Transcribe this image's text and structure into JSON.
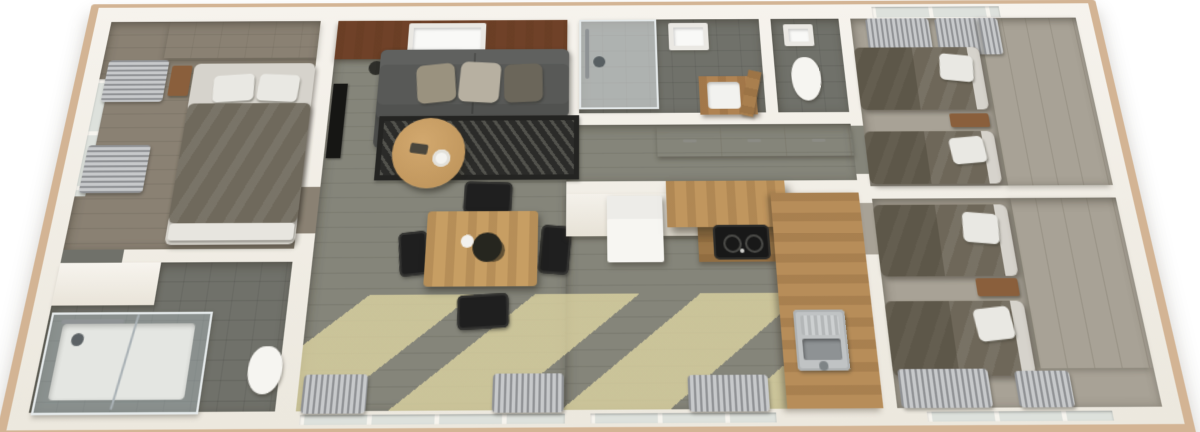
{
  "meta": {
    "kind": "3d-floorplan-top-down-render",
    "background": "#ffffff"
  },
  "palette": {
    "wall": "#f4f1ea",
    "wallLo": "#e9e4d9",
    "rim": "#d3b494",
    "tv": "#161614",
    "floorMain": "#85857a",
    "floorMaster": "#8a8173",
    "floorBath": "#70716a",
    "floorBed": "#a8a296",
    "plank": "#75756a",
    "sun": "#ded5a2",
    "woodCeiling": "#6f4128",
    "woodCab": "#c0965e",
    "woodCounter": "#b78d59",
    "woodDark": "#9c7748",
    "woodTable": "#c79e63",
    "woodNight": "#8a5f3c",
    "sofa": "#585957",
    "sofaSeat": "#4c4d4b",
    "cushA": "#9a927f",
    "cushB": "#b7b0a1",
    "cushC": "#6b665a",
    "rug": "#2b2b29",
    "rugLine": "#6f6f66",
    "chair": "#1f1f1f",
    "duvet": "#6e6759",
    "duvetM": "#6f695c",
    "pillow": "#e9e8e3",
    "sheet": "#d6d3cc",
    "wardrobe": "#ebe8e1",
    "curtain": "#909295",
    "curtainLight": "#c7c9cb",
    "glassFrame": "#e4e9ea",
    "tray": "#e4e6e2",
    "steel": "#c0c3c4",
    "steelDark": "#8e9294",
    "white": "#f7f6f2",
    "cooktop": "#181818",
    "toilet": "#f6f5f1",
    "skyFrame": "#eae8e3",
    "skyGlass": "#f9f9f7",
    "glazing": "#dde1dc"
  },
  "scene": {
    "view": "top-down-3d-cutaway",
    "rooms": [
      {
        "name": "master-bedroom",
        "furniture": [
          "double-bed",
          "two-pillows",
          "duvet",
          "bedside-shelf",
          "overhead-cabinet",
          "west-window",
          "window-curtains"
        ]
      },
      {
        "name": "master-bathroom",
        "furniture": [
          "vanity-cabinet",
          "walk-in-shower",
          "shower-fixture",
          "toilet"
        ]
      },
      {
        "name": "living-dining-room",
        "furniture": [
          "wood-ceiling-panel",
          "skylight",
          "corner-sofa",
          "three-cushions",
          "wall-tv",
          "floor-lamp",
          "area-rug",
          "round-coffee-table",
          "remote-control",
          "white-dish",
          "dining-table",
          "plant-vase",
          "four-dining-chairs",
          "south-windows",
          "window-curtains",
          "sunlight-stripes"
        ]
      },
      {
        "name": "shower-room",
        "furniture": [
          "walk-in-shower",
          "skylight",
          "vanity-sink",
          "mirror-door"
        ]
      },
      {
        "name": "wc",
        "furniture": [
          "toilet",
          "skylight"
        ]
      },
      {
        "name": "hallway",
        "furniture": [
          "storage-drawers"
        ]
      },
      {
        "name": "kitchen",
        "furniture": [
          "refrigerator",
          "base-cabinets",
          "overhead-wood-cabinet",
          "cooktop-two-burners",
          "wood-counter",
          "steel-sink",
          "faucet",
          "south-window",
          "window-curtain",
          "sunlight-stripes"
        ]
      },
      {
        "name": "bedroom-2",
        "furniture": [
          "twin-bed",
          "twin-bed",
          "nightstand",
          "wardrobe",
          "north-window",
          "window-curtains"
        ]
      },
      {
        "name": "bedroom-3",
        "furniture": [
          "twin-bed",
          "twin-bed",
          "nightstand",
          "wardrobe",
          "south-window",
          "window-curtains"
        ]
      }
    ]
  }
}
